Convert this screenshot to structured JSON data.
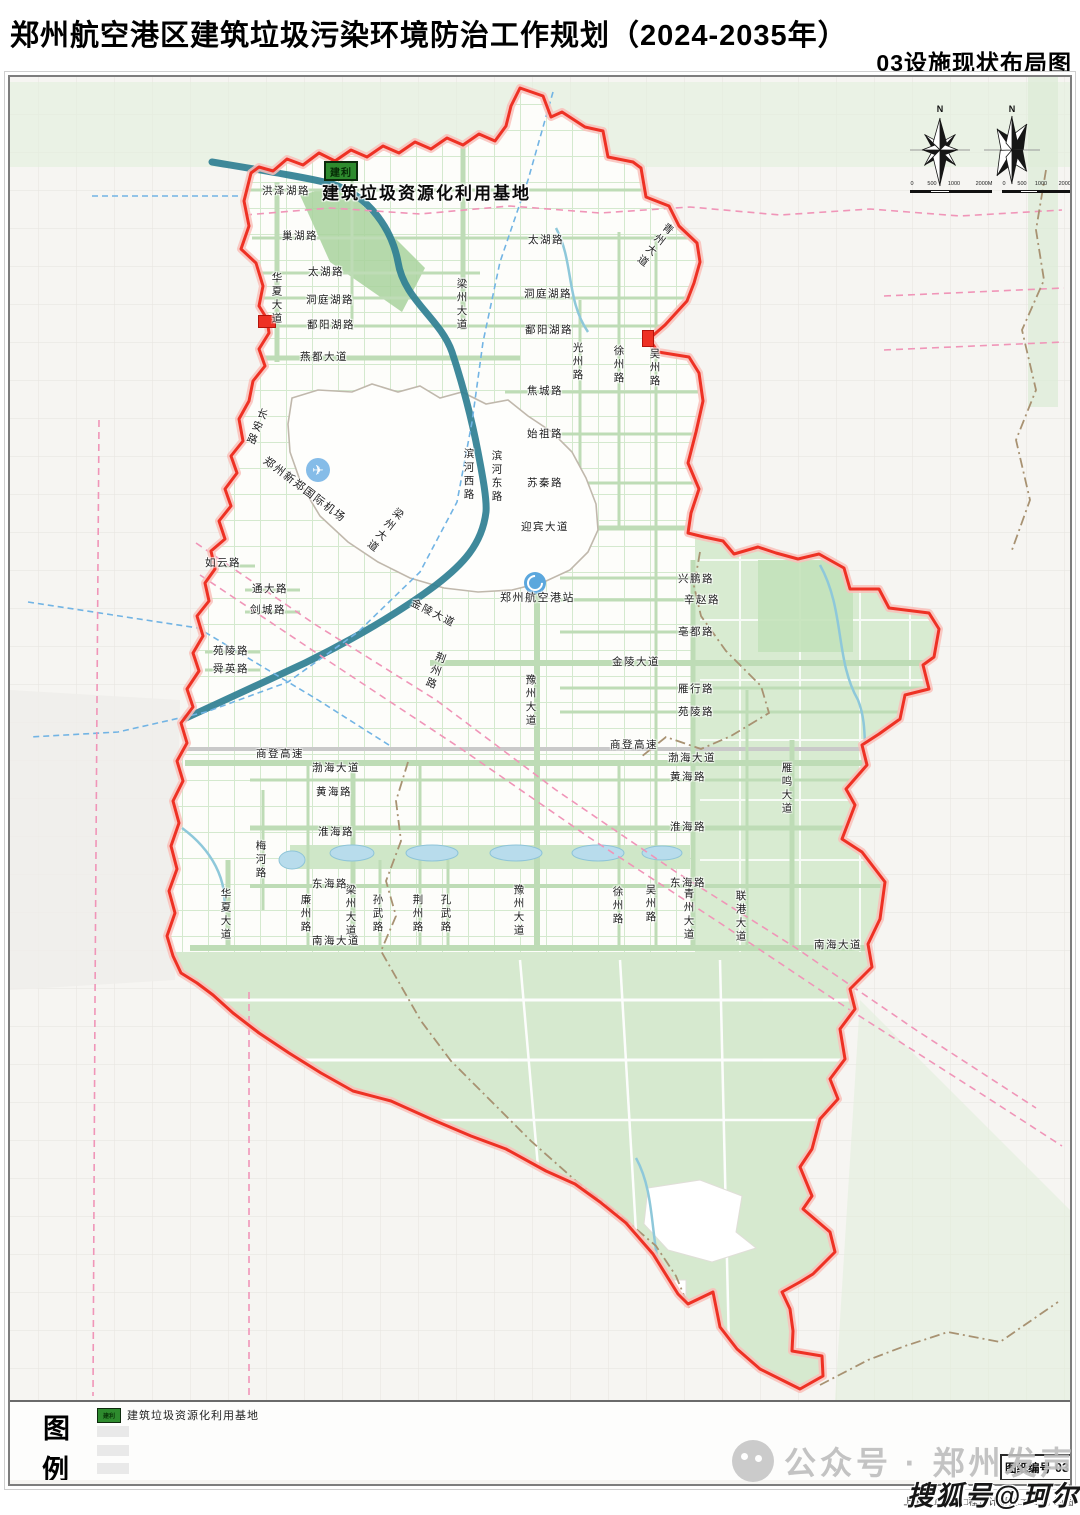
{
  "header": {
    "title": "郑州航空港区建筑垃圾污染环境防治工作规划（2024-2035年）",
    "subtitle": "03设施现状布局图"
  },
  "facility_callout": {
    "badge": "建利",
    "name": "建筑垃圾资源化利用基地"
  },
  "compass": {
    "north": "N",
    "scale_ticks": [
      "0",
      "500",
      "1000",
      "2000M"
    ]
  },
  "legend": {
    "title_top": "图",
    "title_bottom": "例",
    "items": [
      {
        "badge": "建利",
        "label": "建筑垃圾资源化利用基地",
        "color": "#2e8b2e"
      }
    ]
  },
  "sheet_number": {
    "label": "图纸编号",
    "value": "03"
  },
  "watermarks": {
    "wechat": "公众号 · 郑州发声",
    "sohu": "搜狐号@珂尔"
  },
  "credit": "上海□□□业生□程设计研究□□公司 制图",
  "colors": {
    "boundary_red": "#ee3124",
    "facility_green": "#2e8b2e",
    "canal_teal": "#2f7f93",
    "road_green": "#b9d9b1",
    "area_green": "#d8ebd1",
    "rail_pink": "#f095b8",
    "metro_blue": "#72b4e4",
    "county_brown": "#a89272"
  },
  "poi": [
    {
      "name": "airport",
      "label": "郑州新郑国际机场"
    },
    {
      "name": "railway-station",
      "label": "郑州航空港站"
    }
  ],
  "map_labels": [
    {
      "t": "洪泽湖路",
      "x": 262,
      "y": 186
    },
    {
      "t": "巢湖路",
      "x": 282,
      "y": 231
    },
    {
      "t": "太湖路",
      "x": 308,
      "y": 267
    },
    {
      "t": "洞庭湖路",
      "x": 306,
      "y": 295
    },
    {
      "t": "鄱阳湖路",
      "x": 307,
      "y": 320
    },
    {
      "t": "燕都大道",
      "x": 300,
      "y": 352
    },
    {
      "t": "华夏大道",
      "x": 270,
      "y": 272,
      "v": 1
    },
    {
      "t": "梁州大道",
      "x": 455,
      "y": 278,
      "v": 1
    },
    {
      "t": "青州大道",
      "x": 666,
      "y": 220,
      "v": 1,
      "r": 38
    },
    {
      "t": "太湖路",
      "x": 528,
      "y": 235
    },
    {
      "t": "洞庭湖路",
      "x": 524,
      "y": 289
    },
    {
      "t": "鄱阳湖路",
      "x": 525,
      "y": 325
    },
    {
      "t": "光州路",
      "x": 571,
      "y": 342,
      "v": 1
    },
    {
      "t": "徐州路",
      "x": 612,
      "y": 345,
      "v": 1
    },
    {
      "t": "吴州路",
      "x": 648,
      "y": 348,
      "v": 1
    },
    {
      "t": "焦城路",
      "x": 527,
      "y": 386
    },
    {
      "t": "始祖路",
      "x": 527,
      "y": 429
    },
    {
      "t": "苏秦路",
      "x": 527,
      "y": 478
    },
    {
      "t": "迎宾大道",
      "x": 521,
      "y": 522
    },
    {
      "t": "滨河西路",
      "x": 462,
      "y": 448,
      "v": 1
    },
    {
      "t": "滨河东路",
      "x": 490,
      "y": 450,
      "v": 1
    },
    {
      "t": "长安路",
      "x": 258,
      "y": 406,
      "v": 1,
      "r": 22
    },
    {
      "t": "郑州新郑国际机场",
      "x": 268,
      "y": 455,
      "r": 37,
      "s": 11
    },
    {
      "t": "梁州大道",
      "x": 396,
      "y": 505,
      "v": 1,
      "r": 38
    },
    {
      "t": "如云路",
      "x": 205,
      "y": 558
    },
    {
      "t": "通大路",
      "x": 252,
      "y": 584
    },
    {
      "t": "剑城路",
      "x": 250,
      "y": 605
    },
    {
      "t": "苑陵路",
      "x": 213,
      "y": 646
    },
    {
      "t": "舜英路",
      "x": 213,
      "y": 664
    },
    {
      "t": "郑州航空港站",
      "x": 500,
      "y": 592,
      "s": 11
    },
    {
      "t": "兴鹏路",
      "x": 678,
      "y": 574
    },
    {
      "t": "辛赵路",
      "x": 684,
      "y": 595
    },
    {
      "t": "亳都路",
      "x": 678,
      "y": 627
    },
    {
      "t": "金陵大道",
      "x": 612,
      "y": 657
    },
    {
      "t": "金陵大道",
      "x": 414,
      "y": 598,
      "r": 27
    },
    {
      "t": "荆州路",
      "x": 436,
      "y": 650,
      "v": 1,
      "r": 20
    },
    {
      "t": "豫州大道",
      "x": 524,
      "y": 674,
      "v": 1
    },
    {
      "t": "雁行路",
      "x": 678,
      "y": 684
    },
    {
      "t": "苑陵路",
      "x": 678,
      "y": 707
    },
    {
      "t": "商登高速",
      "x": 610,
      "y": 740
    },
    {
      "t": "商登高速",
      "x": 256,
      "y": 749
    },
    {
      "t": "渤海大道",
      "x": 668,
      "y": 753
    },
    {
      "t": "渤海大道",
      "x": 312,
      "y": 763
    },
    {
      "t": "黄海路",
      "x": 670,
      "y": 772
    },
    {
      "t": "黄海路",
      "x": 316,
      "y": 787
    },
    {
      "t": "雁鸣大道",
      "x": 780,
      "y": 762,
      "v": 1
    },
    {
      "t": "淮海路",
      "x": 670,
      "y": 822
    },
    {
      "t": "淮海路",
      "x": 318,
      "y": 827
    },
    {
      "t": "梅河路",
      "x": 254,
      "y": 840,
      "v": 1
    },
    {
      "t": "东海路",
      "x": 670,
      "y": 878
    },
    {
      "t": "东海路",
      "x": 312,
      "y": 879
    },
    {
      "t": "华夏大道",
      "x": 219,
      "y": 888,
      "v": 1
    },
    {
      "t": "廉州路",
      "x": 299,
      "y": 894,
      "v": 1
    },
    {
      "t": "梁州大道",
      "x": 344,
      "y": 884,
      "v": 1
    },
    {
      "t": "孙武路",
      "x": 371,
      "y": 894,
      "v": 1
    },
    {
      "t": "荆州路",
      "x": 411,
      "y": 894,
      "v": 1
    },
    {
      "t": "孔武路",
      "x": 439,
      "y": 894,
      "v": 1
    },
    {
      "t": "豫州大道",
      "x": 512,
      "y": 884,
      "v": 1
    },
    {
      "t": "徐州路",
      "x": 611,
      "y": 886,
      "v": 1
    },
    {
      "t": "吴州路",
      "x": 644,
      "y": 884,
      "v": 1
    },
    {
      "t": "青州大道",
      "x": 682,
      "y": 888,
      "v": 1
    },
    {
      "t": "联港大道",
      "x": 734,
      "y": 890,
      "v": 1
    },
    {
      "t": "南海大道",
      "x": 312,
      "y": 936
    },
    {
      "t": "南海大道",
      "x": 814,
      "y": 940
    }
  ]
}
